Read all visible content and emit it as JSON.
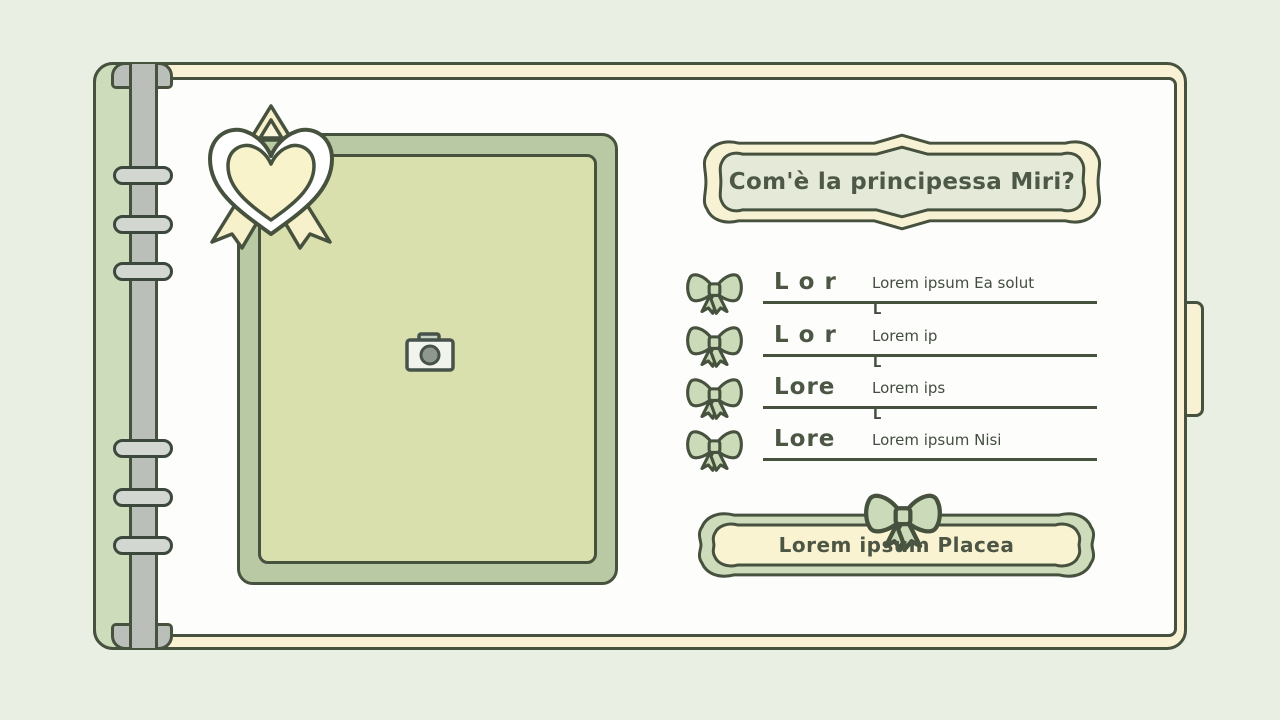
{
  "window": {
    "background_color": "#e9efe2",
    "outline_color": "#46513e"
  },
  "notebook": {
    "cover_color": "#f9f1d3",
    "page_color": "#fdfdfb",
    "spine_color": "#cddcbb",
    "binder_color": "#babfba",
    "ring_color": "#d2d7d2",
    "ring_count": 6
  },
  "photo_frame": {
    "frame_color": "#b9c9a4",
    "inner_color": "#d9e0ae",
    "icon": "camera-icon"
  },
  "award_badge": {
    "icon": "heart-ribbon-badge-icon",
    "heart_color": "#f9f3cc"
  },
  "question_banner": {
    "title": "Com'è la principessa Miri?",
    "band_color": "#f8f2d5",
    "fill_color": "#e4e9d8",
    "text_color": "#4d5847"
  },
  "form": {
    "row_icon": "bow-icon",
    "bow_color": "#cbdbb9",
    "rows": [
      {
        "label": "L o r",
        "value": "Lorem ipsum Ea solut",
        "tail": "L"
      },
      {
        "label": "L o r",
        "value": "Lorem ip",
        "tail": "L"
      },
      {
        "label": "Lore",
        "value": "Lorem ips",
        "tail": "L"
      },
      {
        "label": "Lore",
        "value": "Lorem ipsum Nisi",
        "tail": ""
      }
    ]
  },
  "action_button": {
    "label": "Lorem ipsum Placea",
    "fill_color": "#faf3d1",
    "band_color": "#cfdcbc",
    "text_color": "#4c5645",
    "icon": "bow-icon"
  }
}
